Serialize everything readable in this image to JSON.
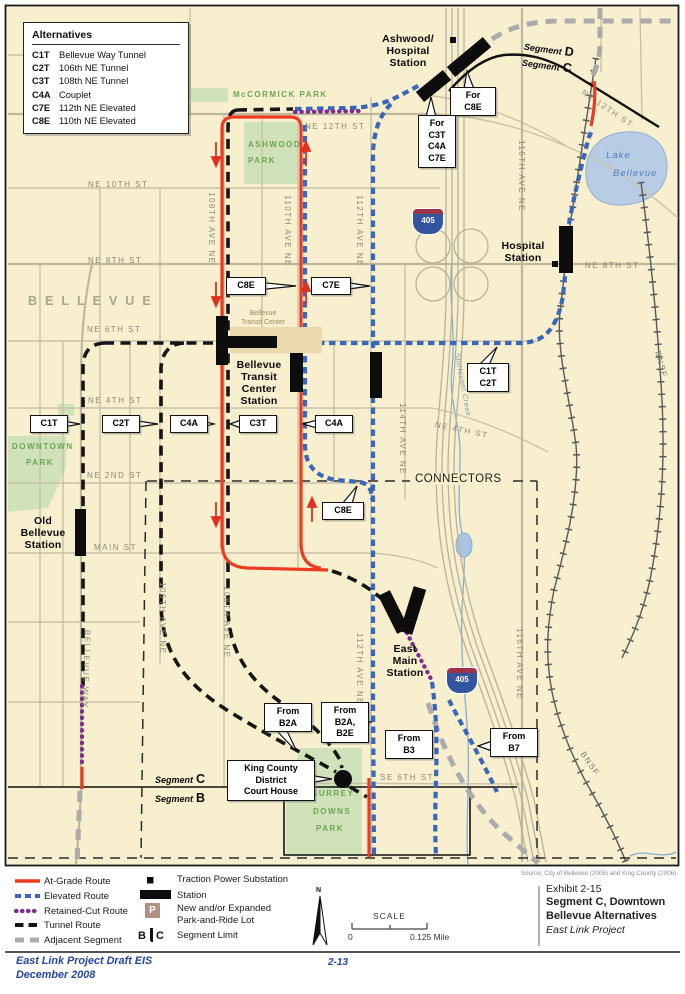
{
  "colors": {
    "at_grade": "#ee3a21",
    "elevated": "#3a67ba",
    "retained": "#7c2d8f",
    "tunnel": "#151515",
    "adjacent": "#ababab",
    "map_bg": "#f7efcd",
    "park": "#cfe2ba",
    "lake": "#b9cce6",
    "station": "#0d0d0d"
  },
  "alternatives_box": {
    "title": "Alternatives",
    "items": [
      {
        "code": "C1T",
        "name": "Bellevue Way Tunnel"
      },
      {
        "code": "C2T",
        "name": "106th NE Tunnel"
      },
      {
        "code": "C3T",
        "name": "108th NE Tunnel"
      },
      {
        "code": "C4A",
        "name": "Couplet"
      },
      {
        "code": "C7E",
        "name": "112th NE Elevated"
      },
      {
        "code": "C8E",
        "name": "110th NE Elevated"
      }
    ]
  },
  "streets": {
    "ne12_w": "NE 12TH ST",
    "ne12_e": "NE 12TH ST",
    "ne10": "NE 10TH ST",
    "ne8_w": "NE 8TH ST",
    "ne8_e": "NE 8TH ST",
    "ne6": "NE 6TH ST",
    "ne4_w": "NE 4TH ST",
    "ne4_e": "NE 4TH ST",
    "ne2": "NE 2ND ST",
    "main": "MAIN ST",
    "se6": "SE 6TH ST",
    "a108": "108TH AVE NE",
    "a110": "110TH AVE NE",
    "a112": "112TH AVE NE",
    "a114": "114TH AVE NE",
    "a116": "116TH AVE NE",
    "a106_s": "106TH AVE NE",
    "a108_s": "108TH AVE NE",
    "a112_s": "112TH AVE NE",
    "a116_s": "116TH AVE NE",
    "bellevue_way": "BELLEVUE WAY"
  },
  "areas": {
    "city": "BELLEVUE",
    "connectors": "CONNECTORS",
    "mccormick": "McCORMICK PARK",
    "ashwood_1": "ASHWOOD",
    "ashwood_2": "PARK",
    "downtown_1": "DOWNTOWN",
    "downtown_2": "PARK",
    "surrey_1": "SURREY",
    "surrey_2": "DOWNS",
    "surrey_3": "PARK",
    "lake_1": "Lake",
    "lake_2": "Bellevue",
    "creek": "Sturtevant Creek",
    "bnsf": "BNSF"
  },
  "stations": {
    "ashwood": [
      "Ashwood/",
      "Hospital",
      "Station"
    ],
    "hospital": [
      "Hospital",
      "Station"
    ],
    "btc": [
      "Bellevue",
      "Transit",
      "Center",
      "Station"
    ],
    "btc_small": [
      "Bellevue",
      "Transit Center"
    ],
    "old_bellevue": [
      "Old",
      "Bellevue",
      "Station"
    ],
    "east_main": [
      "East",
      "Main",
      "Station"
    ]
  },
  "callouts": {
    "c1t": "C1T",
    "c2t": "C2T",
    "c4a_w": "C4A",
    "c3t": "C3T",
    "c4a_e": "C4A",
    "c8e_n": "C8E",
    "c7e": "C7E",
    "c8e_s": "C8E",
    "c1t_c2t": [
      "C1T",
      "C2T"
    ],
    "for_c8e": [
      "For",
      "C8E"
    ],
    "for_c3t": [
      "For",
      "C3T",
      "C4A",
      "C7E"
    ],
    "from_b2a": [
      "From",
      "B2A"
    ],
    "from_b2a_b2e": [
      "From",
      "B2A,",
      "B2E"
    ],
    "from_b3": [
      "From",
      "B3"
    ],
    "from_b7": [
      "From",
      "B7"
    ],
    "courthouse": [
      "King County",
      "District",
      "Court House"
    ]
  },
  "segments": {
    "word": "Segment",
    "top_d": "D",
    "top_c": "C",
    "bottom_c": "C",
    "bottom_b": "B"
  },
  "highway": {
    "i405": "405"
  },
  "legend": {
    "at_grade": "At-Grade Route",
    "elevated": "Elevated Route",
    "retained": "Retained-Cut Route",
    "tunnel": "Tunnel Route",
    "adjacent": "Adjacent Segment",
    "tps": "Traction Power Substation",
    "station": "Station",
    "pr1": "New and/or Expanded",
    "pr2": "Park-and-Ride Lot",
    "p": "P",
    "seg_b": "B",
    "seg_c": "C",
    "segment_limit": "Segment Limit"
  },
  "scale": {
    "label": "SCALE",
    "zero": "0",
    "max": "0.125 Mile"
  },
  "compass": {
    "n": "N"
  },
  "exhibit": {
    "number": "Exhibit 2-15",
    "title1": "Segment C, Downtown",
    "title2": "Bellevue Alternatives",
    "subtitle": "East Link Project",
    "source": "Source: City of Bellevue (2005) and King County (2006)."
  },
  "footer": {
    "doc": "East Link Project Draft EIS",
    "date": "December 2008",
    "page": "2-13"
  }
}
